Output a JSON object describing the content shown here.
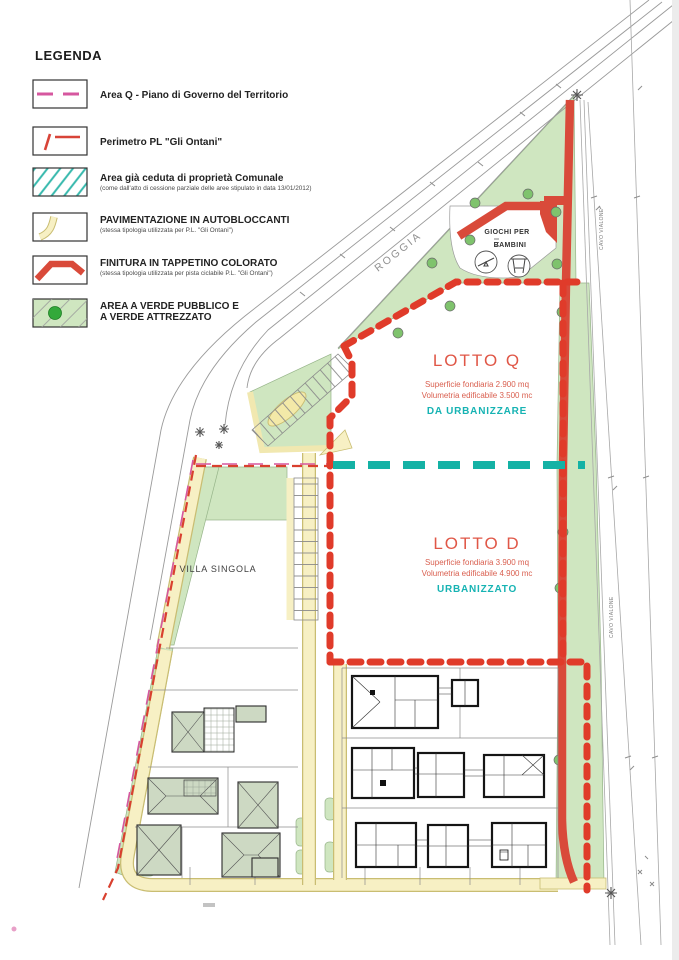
{
  "legend": {
    "title": "LEGENDA",
    "items": [
      {
        "label": "Area Q - Piano di Governo del Territorio"
      },
      {
        "label": "Perimetro PL \"Gli Ontani\""
      },
      {
        "label": "Area già ceduta di proprietà Comunale",
        "sublabel": "(come dall'atto di cessione parziale delle aree stipulato in data 13/01/2012)"
      },
      {
        "label": "PAVIMENTAZIONE IN AUTOBLOCCANTI",
        "sublabel": "(stessa tipologia utilizzata per P.L. \"Gli Ontani\")"
      },
      {
        "label": "FINITURA IN TAPPETINO COLORATO",
        "sublabel": "(stessa tipologia utilizzata per pista ciclabile P.L. \"Gli Ontani\")"
      },
      {
        "line1": "AREA A VERDE PUBBLICO E",
        "line2": "A VERDE ATTREZZATO"
      }
    ]
  },
  "plan": {
    "roggia_label": "ROGGIA",
    "canal_label": "CAVO VIALONE",
    "villa_label": "VILLA SINGOLA",
    "playground": {
      "line1": "GIOCHI PER",
      "line2": "BAMBINI"
    },
    "lotto_q": {
      "title": "LOTTO Q",
      "superficie": "Superficie fondiaria 2.900 mq",
      "volumetria": "Volumetria edificabile  3.500 mc",
      "status": "DA URBANIZZARE"
    },
    "lotto_d": {
      "title": "LOTTO D",
      "superficie": "Superficie fondiaria 3.900 mq",
      "volumetria": "Volumetria edificabile  4.900 mc",
      "status": "URBANIZZATO"
    }
  },
  "colors": {
    "perimeter_red": "#e03b2a",
    "tappetino_red": "#d94a3a",
    "area_q_magenta": "#d6579f",
    "divider_teal": "#14b2a5",
    "green_area": "#cfe6c0",
    "tree_green": "#7fc36d",
    "path_yellow": "#f7f0c4",
    "lotto_text_red": "#e05747",
    "status_teal": "#16b3b3",
    "road_gray": "#9a9a9a"
  }
}
